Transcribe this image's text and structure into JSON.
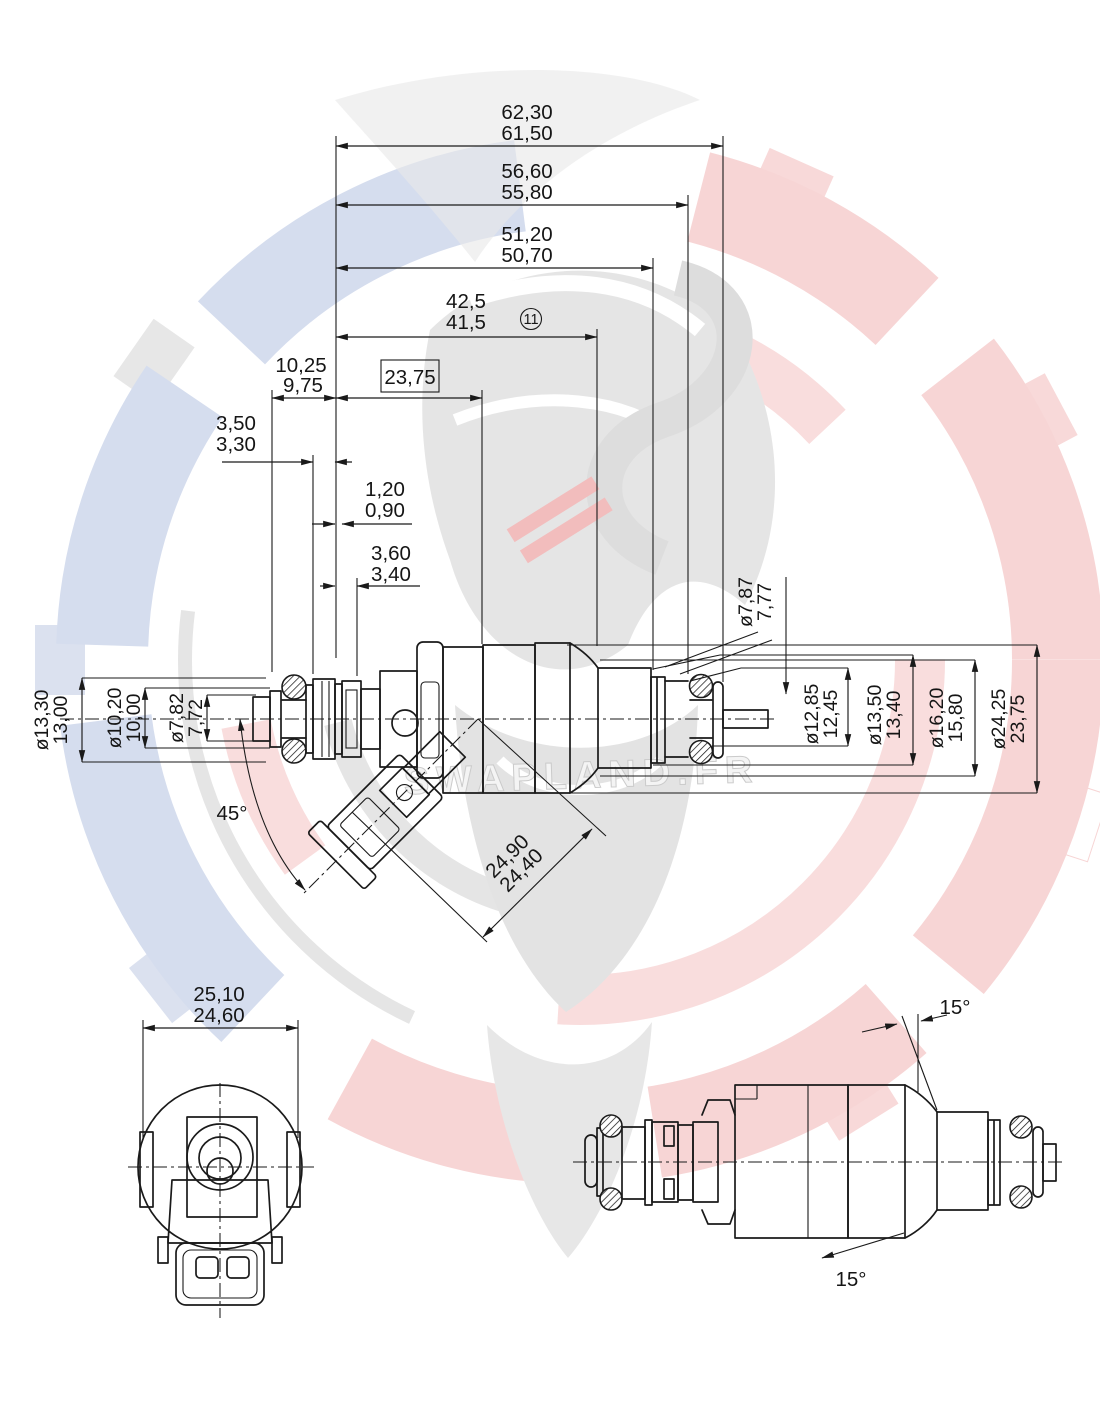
{
  "title": "Fuel injector dimensioned technical drawing",
  "watermark": {
    "text": "SWAPLAND.FR",
    "red": "#f2bcbc",
    "blue": "#bcc8e4",
    "gray": "#d5d5d5"
  },
  "balloon": {
    "label": "11"
  },
  "dims": {
    "overall": {
      "max": "62,30",
      "min": "61,50"
    },
    "len_to_groove": {
      "max": "56,60",
      "min": "55,80"
    },
    "len_to_collar": {
      "max": "51,20",
      "min": "50,70"
    },
    "len_to_shoulder": {
      "max": "42,5",
      "min": "41,5"
    },
    "len_washers": {
      "max": "10,25",
      "min": "9,75"
    },
    "boxed": {
      "value": "23,75"
    },
    "flange_w": {
      "max": "3,50",
      "min": "3,30"
    },
    "washer_w": {
      "max": "1,20",
      "min": "0,90"
    },
    "groove_w": {
      "max": "3,60",
      "min": "3,40"
    },
    "stem": {
      "max": "ø7,87",
      "min": "7,77"
    },
    "cap": {
      "max": "ø13,30",
      "min": "13,00"
    },
    "mid": {
      "max": "ø10,20",
      "min": "10,00"
    },
    "tip": {
      "max": "ø7,82",
      "min": "7,72"
    },
    "seat": {
      "max": "ø12,85",
      "min": "12,45"
    },
    "collar": {
      "max": "ø13,50",
      "min": "13,40"
    },
    "neck": {
      "max": "ø16,20",
      "min": "15,80"
    },
    "body": {
      "max": "ø24,25",
      "min": "23,75"
    },
    "conn_angle": {
      "value": "45°"
    },
    "conn_len": {
      "max": "24,90",
      "min": "24,40"
    },
    "front_w": {
      "max": "25,10",
      "min": "24,60"
    },
    "taper_top": {
      "value": "15°"
    },
    "taper_bot": {
      "value": "15°"
    }
  }
}
